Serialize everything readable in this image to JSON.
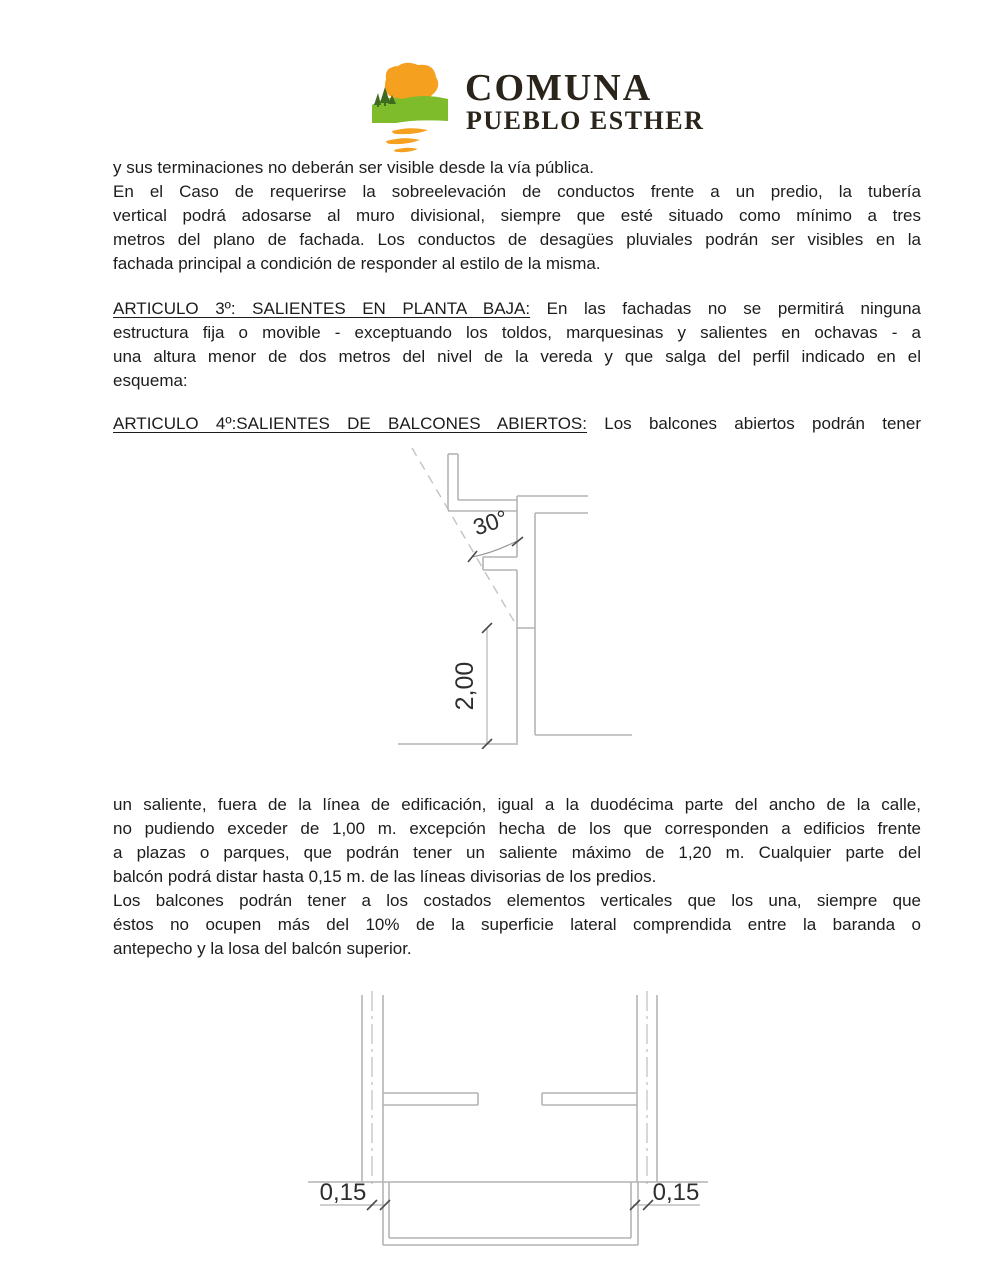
{
  "logo": {
    "title": "COMUNA",
    "subtitle": "PUEBLO ESTHER",
    "colors": {
      "sun": "#F5A01E",
      "hill": "#7FBC2B",
      "trees": "#3E6B1F",
      "waves": "#F5A01E",
      "text": "#2a241b"
    }
  },
  "content": {
    "block1": {
      "lines": [
        "y sus terminaciones no deberán ser visible desde la vía pública.",
        "En el Caso de requerirse la sobreelevación de conductos frente a un predio, la tubería",
        "vertical podrá adosarse al muro divisional, siempre que esté situado como mínimo a tres",
        "metros del plano de fachada. Los conductos de desagües pluviales podrán ser visibles en la",
        "fachada principal a condición de responder al estilo de la misma."
      ]
    },
    "block2": {
      "heading": "ARTICULO 3º: SALIENTES EN PLANTA BAJA:",
      "rest": " En las fachadas no se permitirá ninguna",
      "lines": [
        "estructura fija o movible - exceptuando los toldos, marquesinas y salientes en ochavas - a",
        "una altura menor de dos metros del nivel de la vereda y que salga del perfil indicado en el",
        "esquema:"
      ]
    },
    "block3": {
      "heading": "ARTICULO 4º:SALIENTES DE BALCONES ABIERTOS:",
      "rest": " Los balcones abiertos podrán tener"
    },
    "block4": {
      "lines": [
        "un saliente, fuera de la línea de edificación, igual a la duodécima parte del ancho de la calle,",
        "no pudiendo exceder de 1,00 m. excepción hecha de los que corresponden a edificios frente",
        "a plazas o parques, que podrán tener un saliente máximo de 1,20 m. Cualquier parte del",
        "balcón podrá distar hasta 0,15 m. de las líneas divisorias de los predios.",
        "Los balcones podrán tener a los costados elementos verticales que los una, siempre que",
        "éstos no ocupen más del 10% de la superficie lateral comprendida entre la baranda o",
        "antepecho y la losa del balcón superior."
      ]
    }
  },
  "diagrams": {
    "section": {
      "angle_label": "30°",
      "height_label": "2,00"
    },
    "plan": {
      "left_offset_label": "0,15",
      "right_offset_label": "0,15"
    }
  }
}
